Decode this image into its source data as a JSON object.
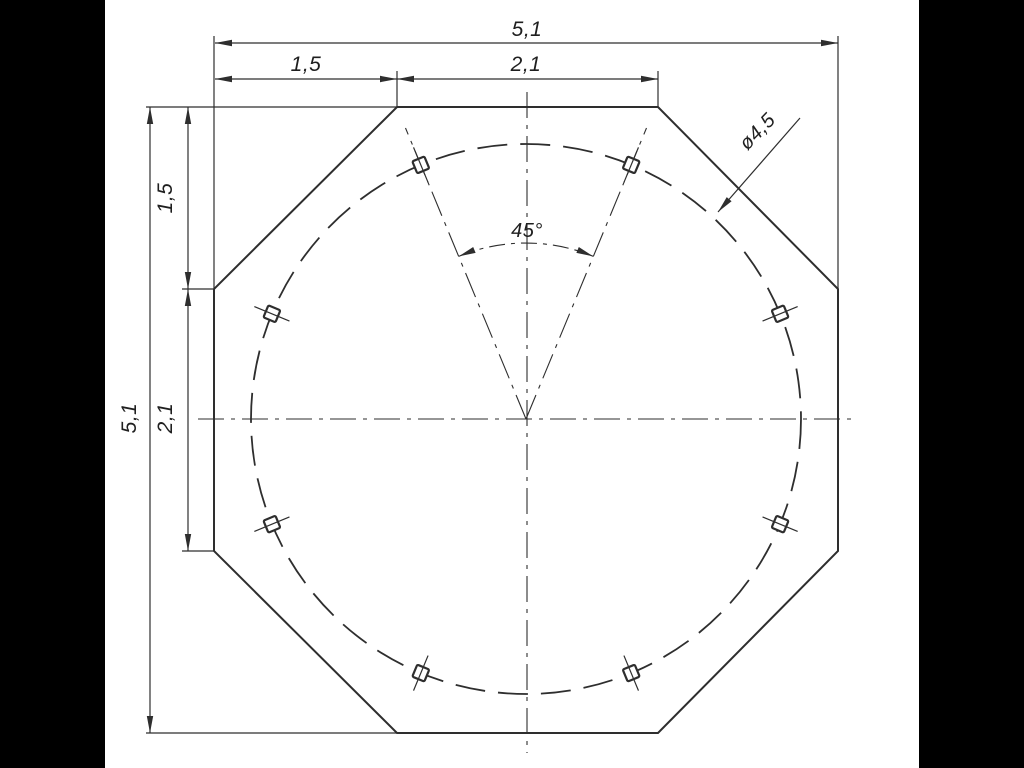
{
  "drawing": {
    "type": "mechanical-part-drawing",
    "subject": "octagonal plate with 8-hole bolt circle",
    "colors": {
      "background": "#ffffff",
      "letterbox": "#000000",
      "line": "#2e2e2e",
      "text": "#1f1f1f"
    },
    "dimensions": {
      "top_total": "5,1",
      "top_left_segment": "1,5",
      "top_right_segment": "2,1",
      "left_total": "5,1",
      "left_top_segment": "1,5",
      "left_mid_segment": "2,1",
      "hole_angle": "45°",
      "hole_diameter": "ø4,5"
    },
    "features": {
      "hole_count": 8,
      "hole_angles_deg": [
        22.5,
        67.5,
        112.5,
        157.5,
        202.5,
        247.5,
        292.5,
        337.5
      ],
      "bolt_circle_style": "dashed",
      "centerline_style": "dash-dot"
    }
  }
}
